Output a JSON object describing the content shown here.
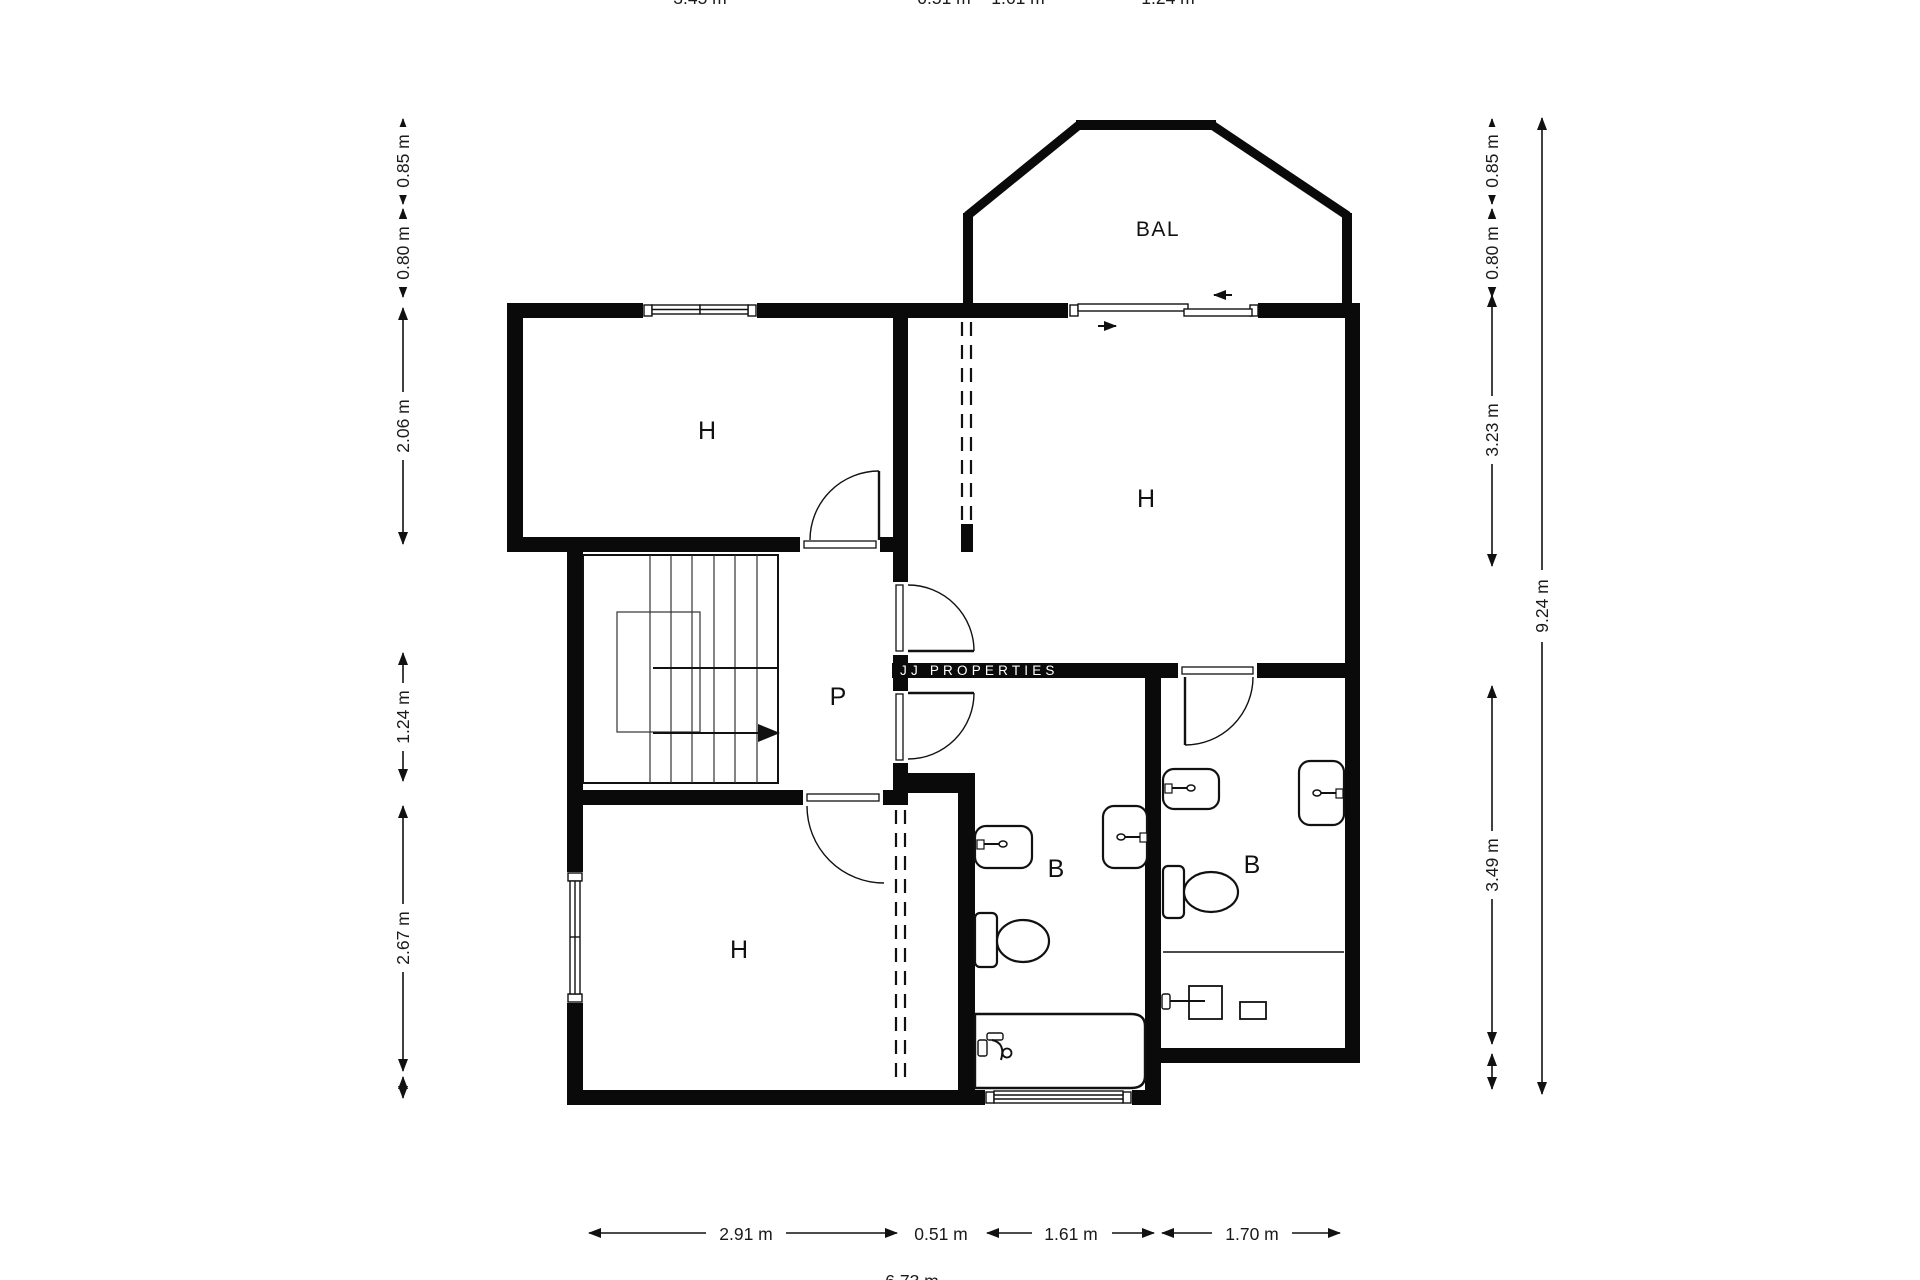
{
  "page": {
    "background": "#ffffff",
    "ink": "#111111"
  },
  "watermark": {
    "text": "JJ PROPERTIES"
  },
  "rooms": {
    "bedroom_top_left": {
      "label": "H"
    },
    "bedroom_top_right": {
      "label": "H"
    },
    "landing": {
      "label": "P"
    },
    "bedroom_bottom_left": {
      "label": "H"
    },
    "bathroom_left": {
      "label": "B"
    },
    "bathroom_right": {
      "label": "B"
    },
    "balcony": {
      "label": "BAL"
    }
  },
  "dimensions": {
    "left": [
      "0.85 m",
      "0.80 m",
      "2.06 m",
      "1.24 m",
      "2.67 m"
    ],
    "right_inner": [
      "0.85 m",
      "0.80 m",
      "3.23 m",
      "3.49 m"
    ],
    "right_outer": "9.24 m",
    "bottom": [
      "2.91 m",
      "0.51 m",
      "1.61 m",
      "1.70 m"
    ],
    "top_partial": [
      "3.45 m",
      "0.51 m",
      "1.61 m",
      "1.24 m"
    ],
    "bottom_partial": "6.73 m"
  }
}
